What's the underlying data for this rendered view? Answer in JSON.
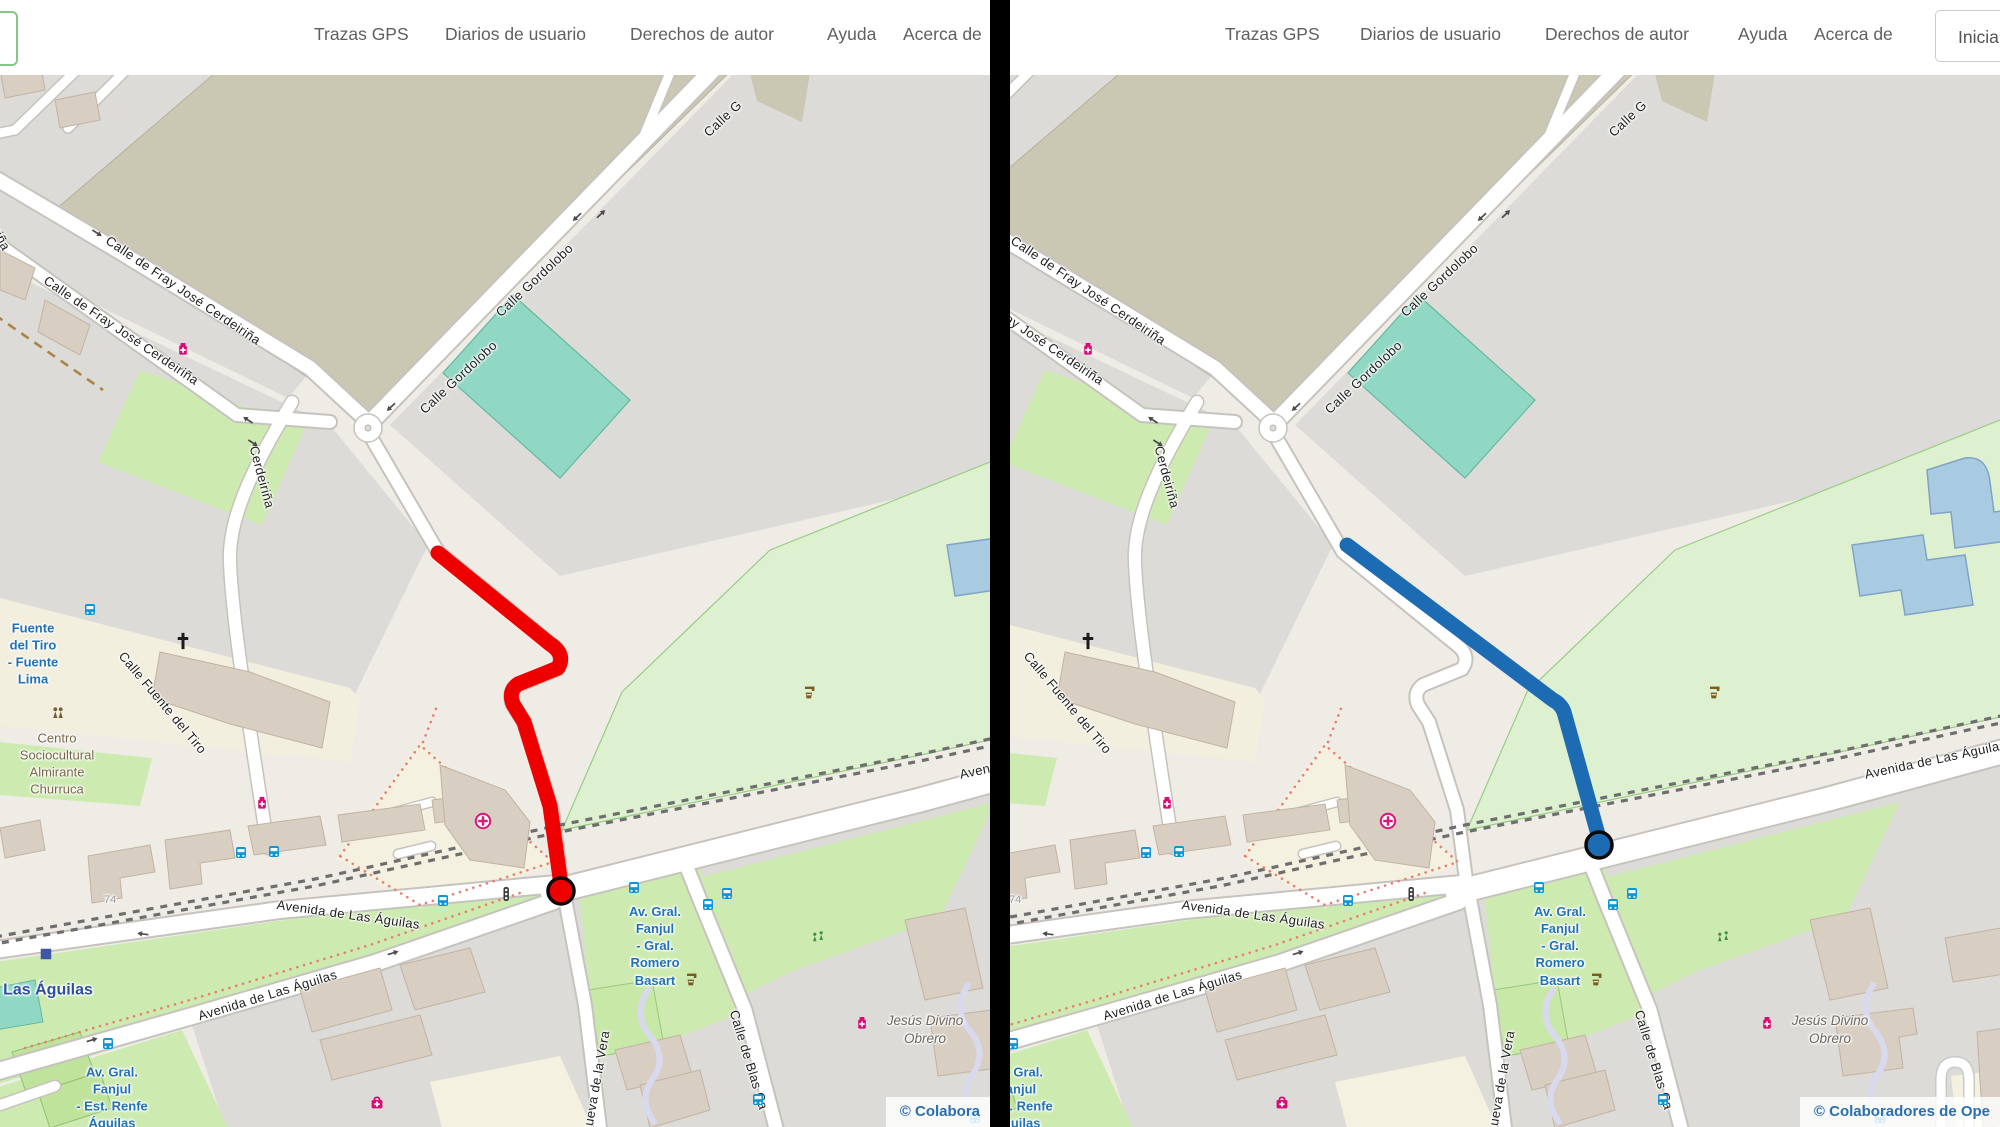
{
  "nav": {
    "items": [
      "Trazas GPS",
      "Diarios de usuario",
      "Derechos de autor",
      "Ayuda",
      "Acerca de"
    ],
    "login_label": "Iniciar"
  },
  "routes": {
    "left": {
      "color": "#ee0000",
      "endpoint_outline": "#0a0a0a"
    },
    "right": {
      "color": "#1d6cb3",
      "endpoint_outline": "#0a0a0a"
    }
  },
  "map": {
    "attribution_left": "© Colabora",
    "attribution_right": "© Colaboradores de Ope",
    "labels": [
      {
        "t": "Calle de Fray José Cerdeiriña",
        "x": 112,
        "y": 232,
        "r": 34,
        "c": "st"
      },
      {
        "t": "Calle de Fray José Cerdeiriña",
        "x": 50,
        "y": 272,
        "r": 34,
        "c": "st"
      },
      {
        "t": "Calle Gordolobo",
        "x": 416,
        "y": 405,
        "r": -43,
        "c": "st"
      },
      {
        "t": "Calle Gordolobo",
        "x": 492,
        "y": 308,
        "r": -43,
        "c": "st"
      },
      {
        "t": "Calle G",
        "x": 700,
        "y": 128,
        "r": -43,
        "c": "st"
      },
      {
        "t": "Calle Fuente del Tiro",
        "x": 128,
        "y": 648,
        "r": 50,
        "c": "st"
      },
      {
        "t": "Cerdeiriña",
        "x": 262,
        "y": 444,
        "r": 75,
        "c": "st"
      },
      {
        "t": "iriña",
        "x": 2,
        "y": 222,
        "r": 62,
        "c": "st"
      },
      {
        "t": "Avenida de Las Águilas",
        "x": 278,
        "y": 896,
        "r": 8,
        "c": "st"
      },
      {
        "t": "Avenida de Las Águilas",
        "x": 196,
        "y": 1008,
        "r": -17,
        "c": "st"
      },
      {
        "t": "Avenida de Las Águilas",
        "x": 958,
        "y": 766,
        "r": -12,
        "c": "st"
      },
      {
        "t": "Calle de Blas Ca",
        "x": 742,
        "y": 1008,
        "r": 73,
        "c": "st"
      },
      {
        "t": "ueva de la Vera",
        "x": 580,
        "y": 1124,
        "r": -80,
        "c": "st"
      },
      {
        "t": "Fuente\ndel Tiro\n- Fuente\nLima",
        "x": 33,
        "y": 654,
        "c": "bl",
        "ctr": true
      },
      {
        "t": "Centro\nSociocultural\nAlmirante\nChurruca",
        "x": 57,
        "y": 764,
        "c": "br",
        "ctr": true
      },
      {
        "t": "Las Águilas",
        "x": 48,
        "y": 990,
        "c": "stn",
        "ctr": true
      },
      {
        "t": "Av. Gral.\nFanjul\n- Gral.\nRomero\nBasart",
        "x": 655,
        "y": 946,
        "c": "bl",
        "ctr": true
      },
      {
        "t": "Av. Gral.\nFanjul\n- Est. Renfe\nÁguilas",
        "x": 112,
        "y": 1098,
        "c": "bl",
        "ctr": true
      },
      {
        "t": "Jesús Divino\nObrero",
        "x": 925,
        "y": 1030,
        "c": "it",
        "ctr": true
      },
      {
        "t": "74",
        "x": 104,
        "y": 893,
        "c": "num"
      }
    ],
    "icons": [
      {
        "k": "bus",
        "x": 90,
        "y": 610
      },
      {
        "k": "bus",
        "x": 241,
        "y": 853
      },
      {
        "k": "bus",
        "x": 274,
        "y": 852
      },
      {
        "k": "bus",
        "x": 443,
        "y": 901
      },
      {
        "k": "bus",
        "x": 634,
        "y": 888
      },
      {
        "k": "bus",
        "x": 708,
        "y": 905
      },
      {
        "k": "bus",
        "x": 727,
        "y": 894
      },
      {
        "k": "bus",
        "x": 108,
        "y": 1044
      },
      {
        "k": "bus",
        "x": 758,
        "y": 1100
      },
      {
        "k": "bus",
        "x": 975,
        "y": 1118
      },
      {
        "k": "metro",
        "x": 46,
        "y": 954,
        "s": 14
      },
      {
        "k": "tl",
        "x": 506,
        "y": 894
      },
      {
        "k": "phm",
        "x": 183,
        "y": 349
      },
      {
        "k": "phm",
        "x": 262,
        "y": 803
      },
      {
        "k": "clinic",
        "x": 483,
        "y": 821,
        "s": 18
      },
      {
        "k": "phm",
        "x": 862,
        "y": 1023
      },
      {
        "k": "aid",
        "x": 377,
        "y": 1103
      },
      {
        "k": "crossR",
        "x": 183,
        "y": 641,
        "s": 20
      },
      {
        "k": "people",
        "x": 58,
        "y": 713
      },
      {
        "k": "play",
        "x": 818,
        "y": 936
      },
      {
        "k": "fountain",
        "x": 810,
        "y": 692
      },
      {
        "k": "fountain",
        "x": 692,
        "y": 979
      },
      {
        "k": "arrow",
        "x": 97,
        "y": 233,
        "r": 33
      },
      {
        "k": "arrow",
        "x": 248,
        "y": 420,
        "r": 213
      },
      {
        "k": "arrow",
        "x": 253,
        "y": 443,
        "r": 33
      },
      {
        "k": "arrow",
        "x": 577,
        "y": 217,
        "r": 137
      },
      {
        "k": "arrow",
        "x": 601,
        "y": 214,
        "r": -43
      },
      {
        "k": "arrow",
        "x": 391,
        "y": 407,
        "r": 137
      },
      {
        "k": "arrow",
        "x": 143,
        "y": 934,
        "r": 187
      },
      {
        "k": "arrow",
        "x": 393,
        "y": 953,
        "r": -17
      },
      {
        "k": "arrow",
        "x": 92,
        "y": 1040,
        "r": -17
      }
    ]
  }
}
